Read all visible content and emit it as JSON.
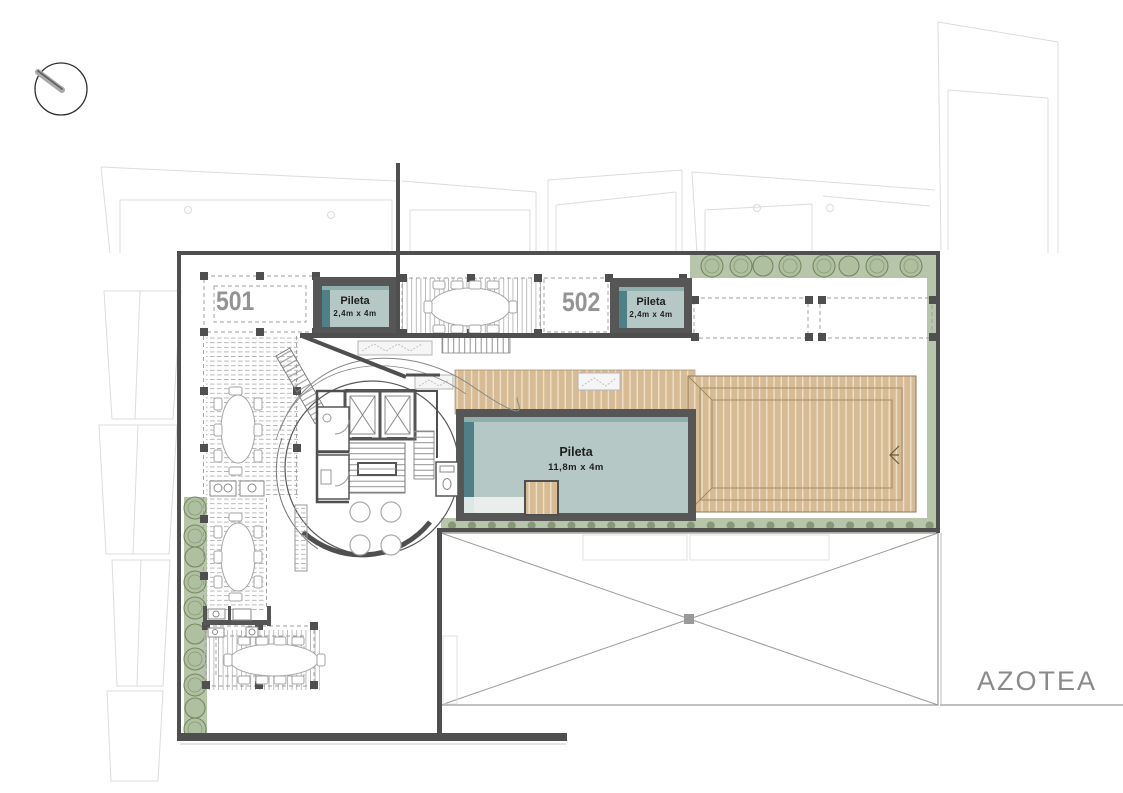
{
  "labels": {
    "unit_501": "501",
    "unit_502": "502",
    "floor_name": "AZOTEA"
  },
  "pools": [
    {
      "name": "Pileta",
      "size": "2,4m x 4m"
    },
    {
      "name": "Pileta",
      "size": "2,4m x 4m"
    },
    {
      "name": "Pileta",
      "size": "11,8m x 4m"
    }
  ],
  "icons": {
    "north_arrow": "north-arrow"
  },
  "colors": {
    "pool_water": "#b6c8c5",
    "pool_edge": "#4e8087",
    "pool_frame": "#565656",
    "wood_deck": "#d6bb95",
    "planting": "#b7c6ab",
    "wall": "#4f4f4f",
    "unit_label": "#949494",
    "floor_label": "#8a8a8a",
    "faint_outline": "#dcdcdc"
  }
}
